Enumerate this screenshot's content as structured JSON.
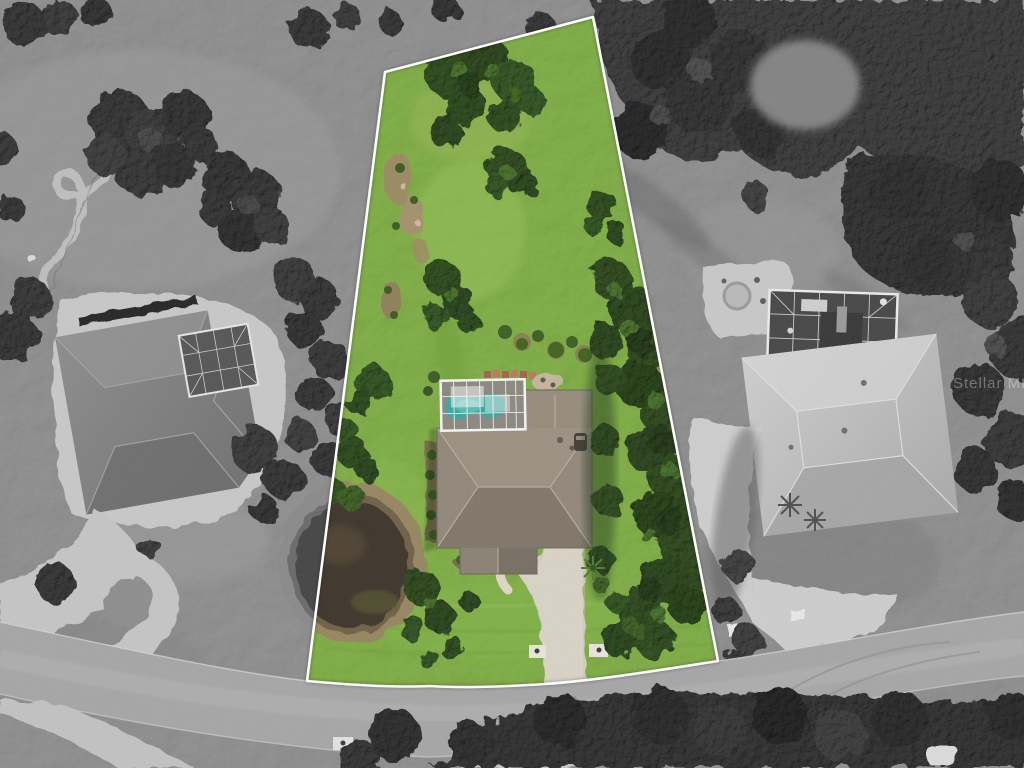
{
  "image": {
    "kind": "aerial-property-photo",
    "watermark": "Stellar MLS"
  },
  "palette": {
    "boundary_white": "#ffffff",
    "parcel_grass": "#7fae45",
    "tree_green_dark": "#2e4a1c",
    "pool_teal": "#3da69e",
    "roof_gray_brown": "#918779",
    "driveway_concrete": "#d9d3c6",
    "road_asphalt": "#a6a6a6",
    "pond_water_brown": "#3e352a",
    "pond_bank_tan": "#96855f",
    "surroundings_gray": "#8f8f8f"
  }
}
